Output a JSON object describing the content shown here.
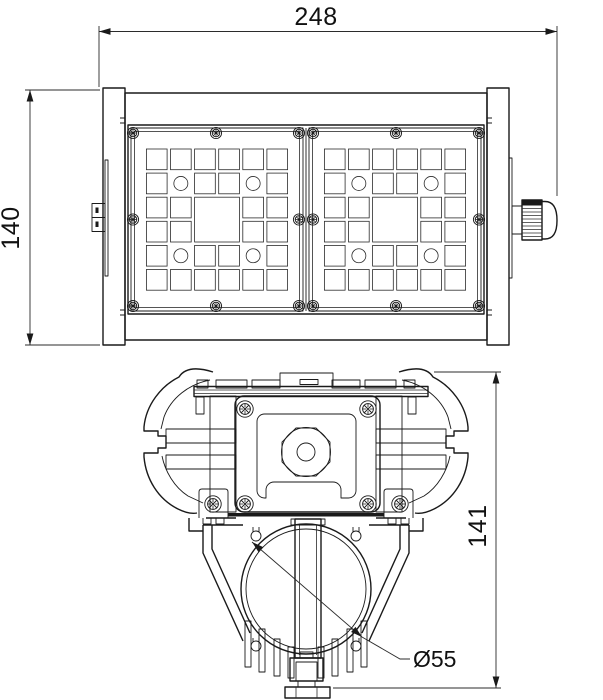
{
  "drawing": {
    "kind": "technical-drawing",
    "subject": "LED linear luminaire - front view with two lens modules and cross-section profile",
    "units": "mm",
    "colors": {
      "background": "#ffffff",
      "line": "#1a1a1a",
      "text": "#111111"
    },
    "dimensions": {
      "width": {
        "label": "248"
      },
      "height": {
        "label": "140"
      },
      "section_height": {
        "label": "141"
      },
      "tube_diameter": {
        "label": "Ø55"
      }
    },
    "front_view": {
      "screws": [
        [
          133,
          133
        ],
        [
          216,
          133
        ],
        [
          299,
          133
        ],
        [
          313,
          133
        ],
        [
          396,
          133
        ],
        [
          479,
          133
        ],
        [
          133,
          219.5
        ],
        [
          299,
          219.5
        ],
        [
          313,
          219.5
        ],
        [
          479,
          219.5
        ],
        [
          133,
          306
        ],
        [
          216,
          306
        ],
        [
          299,
          306
        ],
        [
          313,
          306
        ],
        [
          396,
          306
        ],
        [
          479,
          306
        ]
      ],
      "lens_grid": {
        "cols": 6,
        "rows": 6,
        "cell": 20.7,
        "pitch": 24.1,
        "circle_cells": [
          [
            1,
            1
          ],
          [
            4,
            1
          ],
          [
            1,
            4
          ],
          [
            4,
            4
          ]
        ],
        "circle_r": 7,
        "big": {
          "col": 2,
          "row": 2,
          "span": 2
        }
      },
      "panels": [
        {
          "x": 146.4,
          "y": 149
        },
        {
          "x": 324.4,
          "y": 149
        }
      ],
      "gland_thread_ys": [
        208.5,
        212,
        215.5,
        219,
        222.5,
        226,
        229.5,
        233,
        236.5
      ]
    },
    "section_view": {
      "screws": [
        [
          245,
          409
        ],
        [
          368,
          409
        ],
        [
          213,
          504
        ],
        [
          245,
          504
        ],
        [
          368,
          504
        ],
        [
          400,
          504
        ]
      ],
      "rail_teeth": [
        [
          197,
          380,
          11,
          8
        ],
        [
          216,
          380,
          31,
          8
        ],
        [
          252,
          380,
          28,
          8
        ],
        [
          280,
          373,
          53,
          13.5
        ],
        [
          332,
          380,
          28,
          8
        ],
        [
          365,
          380,
          31,
          8
        ],
        [
          404,
          380,
          11,
          8
        ]
      ],
      "fins": [
        [
          245,
          621,
          6,
          46
        ],
        [
          259,
          629,
          6,
          43
        ],
        [
          274,
          639,
          6,
          37
        ],
        [
          288,
          647,
          6,
          31
        ],
        [
          318,
          647,
          6,
          31
        ],
        [
          332,
          639,
          6,
          37
        ],
        [
          347,
          629,
          6,
          43
        ],
        [
          361,
          621,
          6,
          46
        ]
      ],
      "nut_octagon": "330,461.9 316,476 296,476 282,461.9 282,442.1 296,428 316,428 330,442.1"
    }
  }
}
